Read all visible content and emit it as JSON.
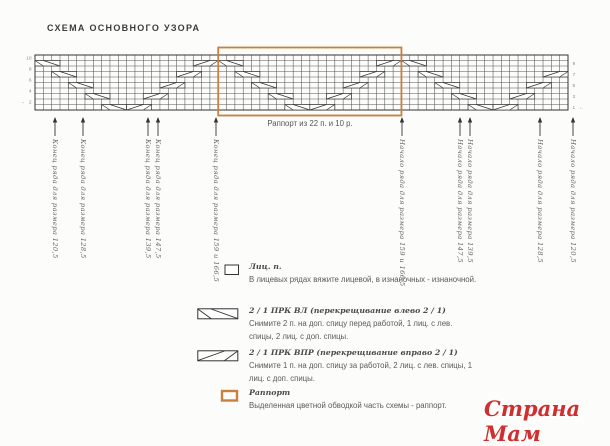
{
  "title": "СХЕМА ОСНОВНОГО УЗОРА",
  "watermark": "Страна Мам",
  "colors": {
    "rapport": "#c8803c",
    "grid": "#555555",
    "symbol": "#333333",
    "numbers": "#8a8a8a",
    "watermark": "#d02f2f"
  },
  "chart_data": {
    "type": "knitting-chart",
    "rows": 10,
    "cols": 64,
    "rapport": {
      "stitches": 22,
      "rows": 10,
      "start_col": 22,
      "label": "Раппорт из 22 п. и 10 р."
    },
    "row_numbers_left": [
      {
        "n": "10"
      },
      {
        "n": "8"
      },
      {
        "n": "6"
      },
      {
        "n": "4"
      },
      {
        "n": "2",
        "arrow": "→"
      }
    ],
    "row_numbers_right": [
      {
        "n": "9"
      },
      {
        "n": "7"
      },
      {
        "n": "5"
      },
      {
        "n": "3"
      },
      {
        "n": "1",
        "arrow": "←"
      }
    ],
    "cables": {
      "period": 22,
      "left_symbol": "2 / 1 ПРК ВЛ",
      "right_symbol": "2 / 1 ПРК ВПР",
      "left_leg": [
        [
          1,
          0
        ],
        [
          3,
          2
        ],
        [
          5,
          4
        ],
        [
          7,
          6
        ],
        [
          9,
          8
        ]
      ],
      "right_leg": [
        [
          9,
          11
        ],
        [
          7,
          13
        ],
        [
          5,
          15
        ],
        [
          3,
          17
        ],
        [
          1,
          19
        ]
      ]
    },
    "markers": [
      {
        "x": 55,
        "label": "Конец ряда для размера 120,5"
      },
      {
        "x": 83,
        "label": "Конец ряда для размера 128,5"
      },
      {
        "x": 148,
        "label": "Конец ряда для размера 139,5"
      },
      {
        "x": 158,
        "label": "Конец ряда для размера 147,5"
      },
      {
        "x": 216,
        "label": "Конец ряда для размера 159 и 166,5"
      },
      {
        "x": 402,
        "label": "Начало ряда для размера 159 и 166,5"
      },
      {
        "x": 460,
        "label": "Начало ряда для размера 147,5"
      },
      {
        "x": 470,
        "label": "Начало ряда для размера 139,5"
      },
      {
        "x": 540,
        "label": "Начало ряда для размера 128,5"
      },
      {
        "x": 573,
        "label": "Начало ряда для размера 120,5"
      }
    ]
  },
  "legend": {
    "items": [
      {
        "symbol": "knit",
        "title": "Лиц. п.",
        "desc": "В лицевых рядах вяжите лицевой, в изнаночных - изнаночной."
      },
      {
        "symbol": "cable_left",
        "title": "2 / 1 ПРК ВЛ (перекрещивание влево 2 / 1)",
        "desc": "Снимите 2 п. на доп. спицу перед работой, 1 лиц. с лев. спицы, 2 лиц. с доп. спицы."
      },
      {
        "symbol": "cable_right",
        "title": "2 / 1 ПРК ВПР (перекрещивание вправо 2 / 1)",
        "desc": "Снимите 1 п. на доп. спицу за работой, 2 лиц. с лев. спицы, 1 лиц. с доп. спицы."
      },
      {
        "symbol": "rapport",
        "title": "Раппорт",
        "desc": "Выделенная цветной обводкой часть схемы - раппорт."
      }
    ]
  }
}
